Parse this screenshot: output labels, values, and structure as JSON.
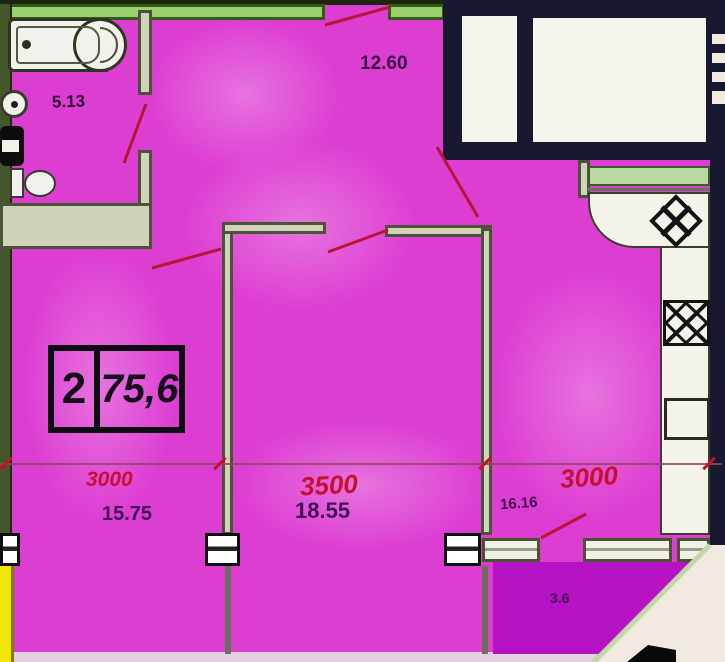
{
  "plan": {
    "unit": {
      "rooms": "2",
      "area": "75,6"
    },
    "areas": {
      "bathroom": "5.13",
      "hallway": "12.60",
      "room_left": "15.75",
      "room_middle": "18.55",
      "kitchen": "16.16",
      "balcony": "3.6"
    },
    "dimensions": {
      "left": "3000",
      "middle": "3500",
      "right": "3000"
    },
    "colors": {
      "floor_fill": "#dd3ed2",
      "balcony_fill": "#b513c3",
      "adjacent_unit_fill": "#f0e609",
      "exterior_wall_green": "#9bd06e",
      "loggia_wall_navy": "#181830",
      "dimension_text_red": "#c5102f",
      "area_text_purple": "#431055",
      "outside_cream": "#efe9df"
    }
  }
}
